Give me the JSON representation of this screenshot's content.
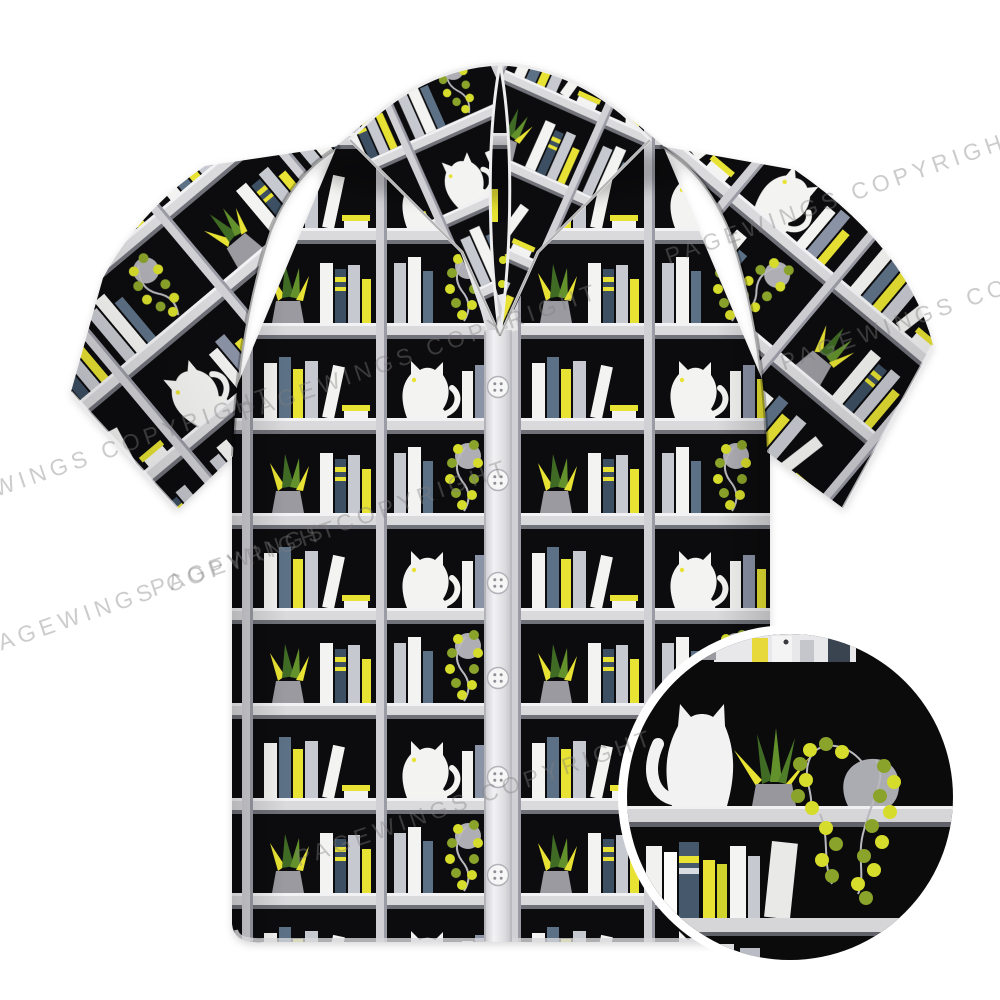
{
  "image": {
    "kind": "e-commerce product photo",
    "subject": "Short-sleeve camp-collar shirt with black bookshelf pattern of white cats, books and plants",
    "background": "#ffffff"
  },
  "watermark": {
    "text": "PAGEWINGS COPYRIGHT",
    "color": "#808080",
    "opacity": 0.4,
    "angle_deg": -19
  },
  "shirt": {
    "collar_style": "camp collar",
    "sleeve_style": "short",
    "pattern_palette": {
      "background_black": "#0c0c0e",
      "shelf_gray": "#dadadd",
      "divider_gray": "#d0d0d5",
      "accent_yellow": "#e7e233",
      "book_white": "#f3f3f1",
      "book_gray": "#c7c9d0",
      "book_slate": "#5d7186",
      "book_dark_slate": "#3c4f63",
      "cat_white": "#f3f3f1",
      "leaf_green": "#63912c",
      "leaf_dark_green": "#3f6b24",
      "vine_yellow": "#d6dc2b",
      "vine_olive": "#8aa32a",
      "pot_gray": "#9a9aa0"
    },
    "placket": {
      "button_count": 6,
      "button_color": "#f6f6f6"
    }
  },
  "detail_inset": {
    "shape": "circle",
    "ring_color": "#ffffff",
    "shows": "close-up of white cat, potted succulent, hanging vine plant on black shelf with books below"
  }
}
